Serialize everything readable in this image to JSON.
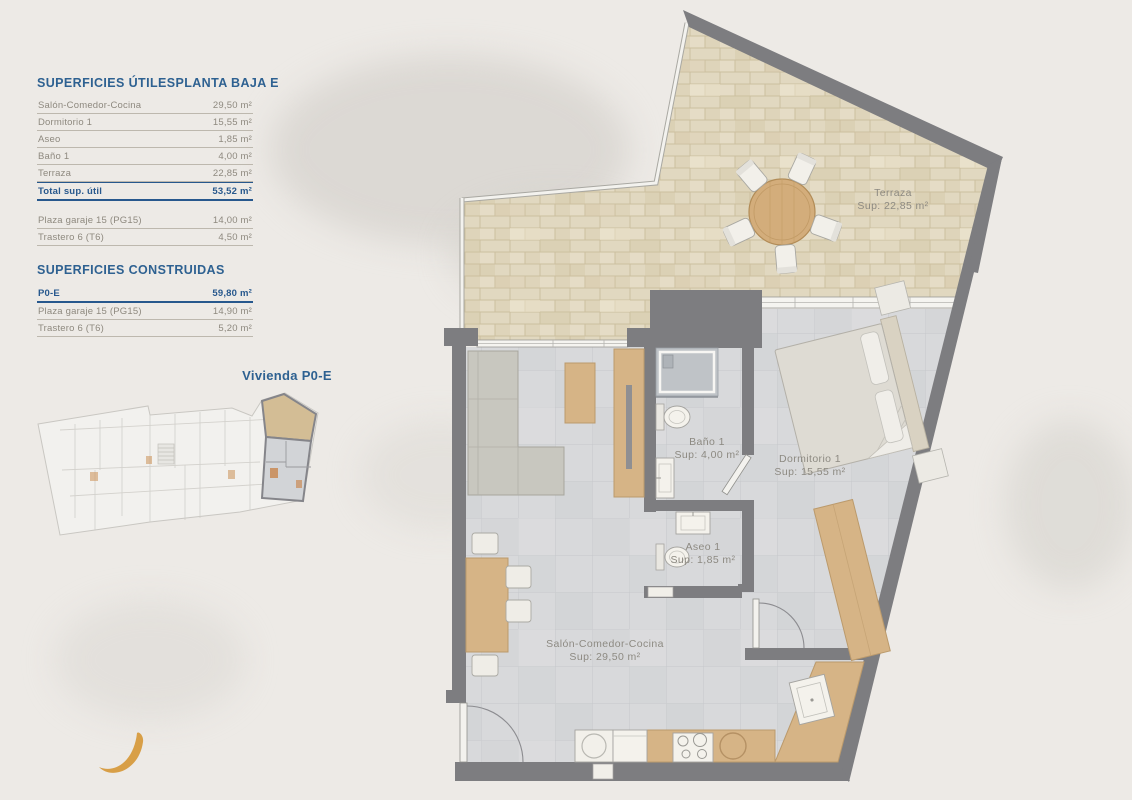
{
  "colors": {
    "accent_blue": "#2e6191",
    "total_blue": "#27588d",
    "wall_gray": "#7d7d80",
    "terrace_tan": "#e2d9c1",
    "floor_gray": "#d8d9db",
    "wood": "#d6b486",
    "plan_label_gray": "#8d8a82",
    "crescent_gold": "#d89f47",
    "background": "#edeae6"
  },
  "surfaces_utiles": {
    "title": "SUPERFICIES ÚTILES",
    "plan_title": "PLANTA BAJA E",
    "rows": [
      {
        "label": "Salón-Comedor-Cocina",
        "value": "29,50 m²"
      },
      {
        "label": "Dormitorio 1",
        "value": "15,55 m²"
      },
      {
        "label": "Aseo",
        "value": "1,85 m²"
      },
      {
        "label": "Baño 1",
        "value": "4,00 m²"
      },
      {
        "label": "Terraza",
        "value": "22,85 m²"
      }
    ],
    "total": {
      "label": "Total sup. útil",
      "value": "53,52 m²"
    },
    "annex_rows": [
      {
        "label": "Plaza garaje 15 (PG15)",
        "value": "14,00 m²"
      },
      {
        "label": "Trastero 6 (T6)",
        "value": "4,50 m²"
      }
    ]
  },
  "surfaces_construidas": {
    "title": "SUPERFICIES CONSTRUIDAS",
    "rows": [
      {
        "label": "P0-E",
        "value": "59,80 m²"
      },
      {
        "label": "Plaza garaje 15 (PG15)",
        "value": "14,90 m²"
      },
      {
        "label": "Trastero 6 (T6)",
        "value": "5,20 m²"
      }
    ]
  },
  "mini_plan": {
    "caption": "Vivienda P0-E"
  },
  "floor_plan": {
    "rooms": [
      {
        "name": "Terraza",
        "sup": "Sup: 22,85 m²"
      },
      {
        "name": "Baño 1",
        "sup": "Sup: 4,00 m²"
      },
      {
        "name": "Dormitorio 1",
        "sup": "Sup: 15,55 m²"
      },
      {
        "name": "Aseo 1",
        "sup": "Sup: 1,85 m²"
      },
      {
        "name": "Salón-Comedor-Cocina",
        "sup": "Sup: 29,50 m²"
      }
    ]
  }
}
